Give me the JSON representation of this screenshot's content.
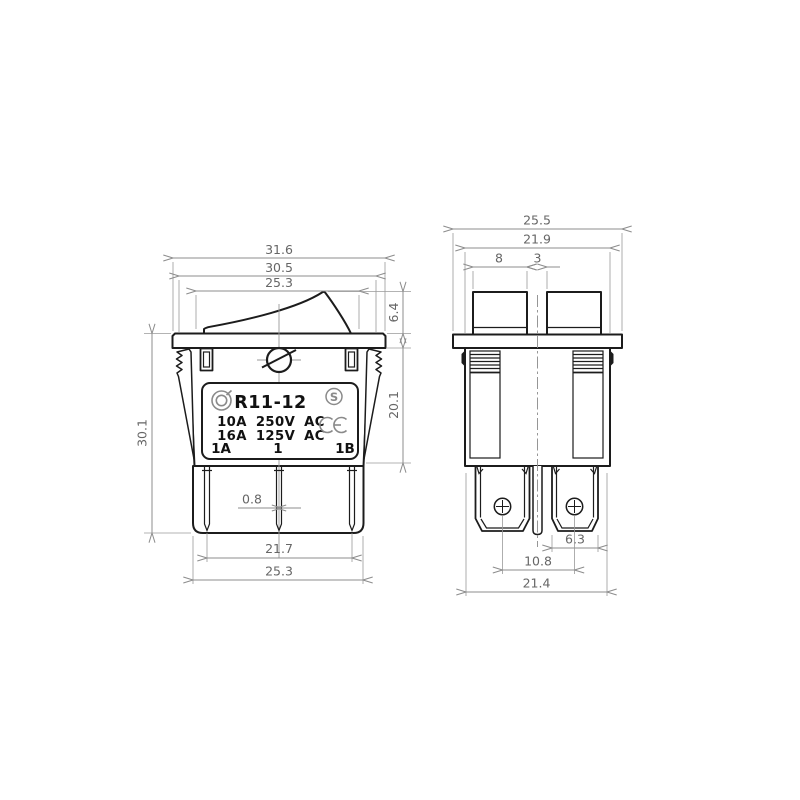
{
  "document": {
    "type": "technical-dimension-drawing",
    "subject": "rocker switch"
  },
  "colors": {
    "background": "#ffffff",
    "part_outline": "#1c1c1c",
    "dimension_lines": "#8c8c8c",
    "dimension_text": "#666666",
    "certification_marks": "#8a8a8a",
    "label_text": "#111111"
  },
  "front_view": {
    "name": "front view",
    "dims": {
      "flange_width": "31.6",
      "flange_top_width": "30.5",
      "rocker_width": "25.3",
      "rocker_height": "6.4",
      "body_depth": "20.1",
      "overall_height": "30.1",
      "blade_thickness": "0.8",
      "blade_span": "21.7",
      "base_width": "25.3"
    },
    "label": {
      "model": "R11-12",
      "rating_line1": "10A 250V AC",
      "rating_line2": "16A 125V AC",
      "terminal_left": "1A",
      "terminal_center": "1",
      "terminal_right": "1B",
      "s_mark": "S"
    }
  },
  "side_view": {
    "name": "side view",
    "dims": {
      "flange_width": "25.5",
      "body_width": "21.9",
      "rocker_half_width": "8",
      "rocker_gap": "3",
      "terminal_width": "6.3",
      "terminal_pitch": "10.8",
      "base_width": "21.4"
    }
  }
}
